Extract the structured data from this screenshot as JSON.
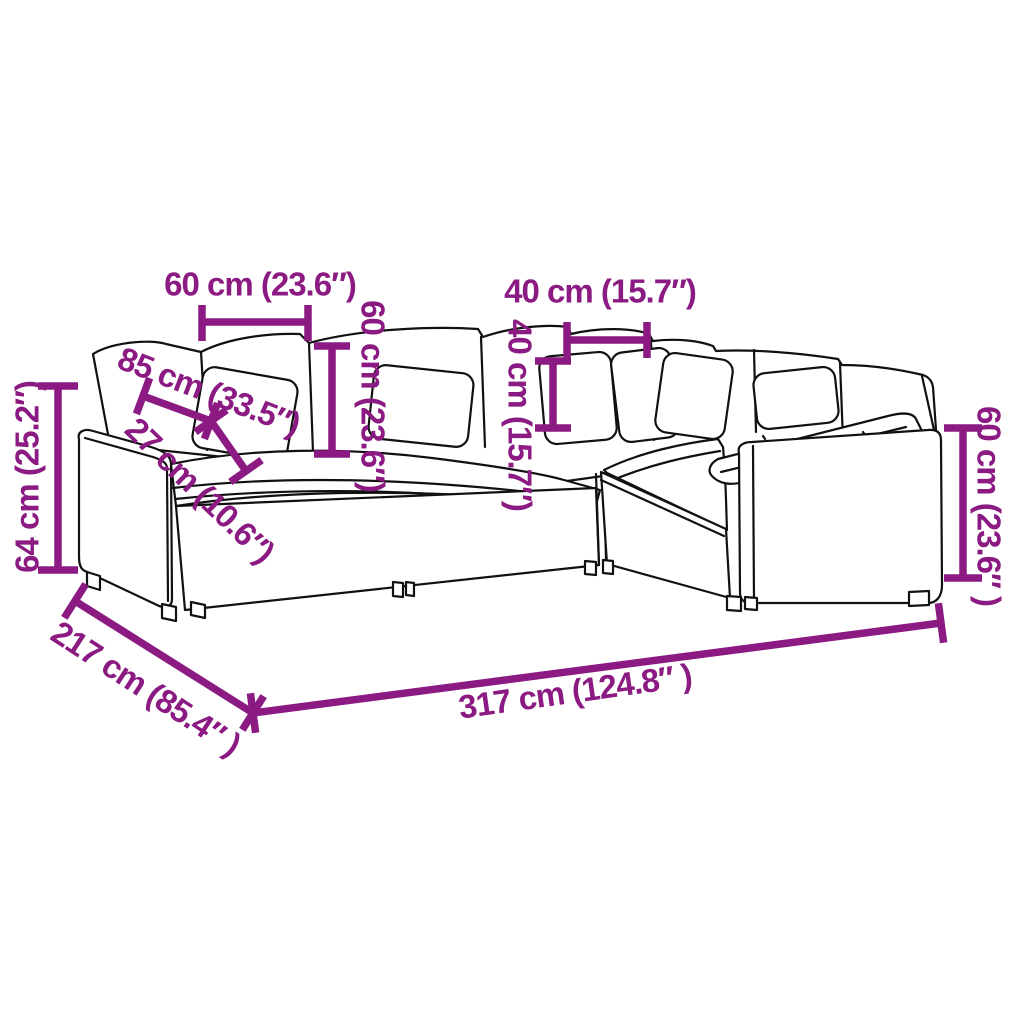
{
  "page": {
    "background": "#ffffff"
  },
  "diagram": {
    "subject": "L-shaped modular sofa with loose cushions — dimension line drawing",
    "accent_color": "#8b1a82",
    "outline_color": "#111111",
    "dimensions": {
      "back_cushion_width": {
        "label": "60 cm (23.6″)"
      },
      "back_cushion_height": {
        "label": "60 cm (23.6″)"
      },
      "corner_cushion_width": {
        "label": "40 cm (15.7″)"
      },
      "corner_cushion_height": {
        "label": "40 cm (15.7″)"
      },
      "seat_depth": {
        "label": "85 cm (33.5″)"
      },
      "armrest_width": {
        "label": "27 cm (10.6″)"
      },
      "armrest_height": {
        "label": "64 cm (25.2″)"
      },
      "right_backrest_height": {
        "label": "60 cm (23.6″ )"
      },
      "total_depth": {
        "label": "217 cm (85.4″ )"
      },
      "total_width": {
        "label": "317 cm (124.8″ )"
      }
    }
  }
}
